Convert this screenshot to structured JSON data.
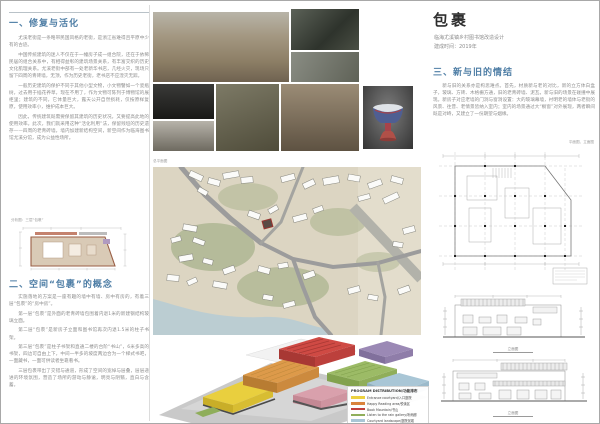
{
  "page": {
    "background": "#ffffff",
    "border_color": "#a8a8a8",
    "accent_heading_color": "#4d7da5"
  },
  "left": {
    "section1": {
      "heading": "一、修复与活化",
      "paragraphs": [
        "尤溪老街是一条略带民国风格的老街，是浙江省难得且平原中少有的古迹。",
        "中国传统建筑的迷人不仅在于一幢房子成一组合院，还在于依稀民居的组合关系中，有相得益彰的建筑场景关系，有丰富交织的历史文化肌理关系。尤溪老街中部有一处老新华书店，几经火灾，现场只留下四周的青砖墙，无顶，作为历史老街，老书店不应湮灭无踪。",
        "一般历史建筑的保护不同于其他小型文物，小文物譬如一个瓷瓶树，过去用于插花养草，现在不用了，作为文物可陈列于博物馆的展柜里；建筑的不同，它体量巨大，露天公开自然损耗，仅按原样复原，使用效率小，维护成本巨大。",
        "因此，传统建筑既需要保留其建筑的历史状况，又要提高此地的使用效率。此次，我们就采用这种“活化利用”法，保留残垣的历史遗存——四周的老青砖墙，墙内加建新结构空间，新空间作为临海图书馆尤溪分馆，成为公益性场所。"
      ]
    },
    "diagram_label": "分析图：三层“包裹”",
    "section2": {
      "heading": "二、空间“包裹”的概念",
      "paragraphs": [
        "实施落地的方案是一座有趣的墙中有墙、房中有房的，有着三层“包裹”的“房中房”。",
        "第一层“包裹”是外面的老青砖墙包围着内退1米的新建钢结构玻璃立面。",
        "第二层“包裹”是新房子立面和图书馆再次内退1.5米的柱子书架。",
        "第三层“包裹”是柱子书架和直通二楼的台阶“书山”，6米多高的书架，四边可自由上下，中间一半多的坡度两边合为一个梯式书吧，一面藏书，一面可供读者坐靠看书。",
        "三层包裹带出了交错与通道，形成了空间的宽绰与层叠，层层递进的环境氛围，营造了场所的游动与静谧，明亮与阴翳，直白与含蓄。"
      ]
    }
  },
  "middle": {
    "map_label": "总平面图",
    "legend": {
      "title": "PROGRAM DISTRIBUTION/功能排布",
      "items": [
        {
          "label": "Entrance courtyard/入口庭院",
          "color": "#ecd13f"
        },
        {
          "label": "Happy Reading area/悦读区",
          "color": "#d9823b"
        },
        {
          "label": "Book Mountain/书山",
          "color": "#bf3f3c"
        },
        {
          "label": "Listen to the rain gallery/听雨廊",
          "color": "#8fae5a"
        },
        {
          "label": "Courtyard landscape/庭院景观",
          "color": "#a9c6d6"
        },
        {
          "label": "Office/办公区",
          "color": "#9b89b5"
        }
      ]
    }
  },
  "right": {
    "title": "包裹",
    "subtitle": "临海尤溪镇乡村图书馆改造设计",
    "completion": "建成时间：2019年",
    "section3": {
      "heading": "三、新与旧的情结",
      "paragraphs": [
        "新与旧的关系亦是构思难点。首先，材质新与老的对比，新的立方体白盒子，玻璃、方砖、木格栅方通，旧的老青砖墙、泥瓦，新与旧的场景在碰撞中展现。新房子对应老墙的门洞与窗洞设置：大的玻璃幕墙，衬明老的墙体与老街的风景、往昔、老情景皆纳入室内；室内的场景通过大“橱窗”对外展现，两者瞬间既是对峙，又建立了一份期望与姻缘。"
      ]
    },
    "drawings_label": "平面图、立面图",
    "elevation_captions": [
      "立面图",
      "立面图"
    ]
  }
}
